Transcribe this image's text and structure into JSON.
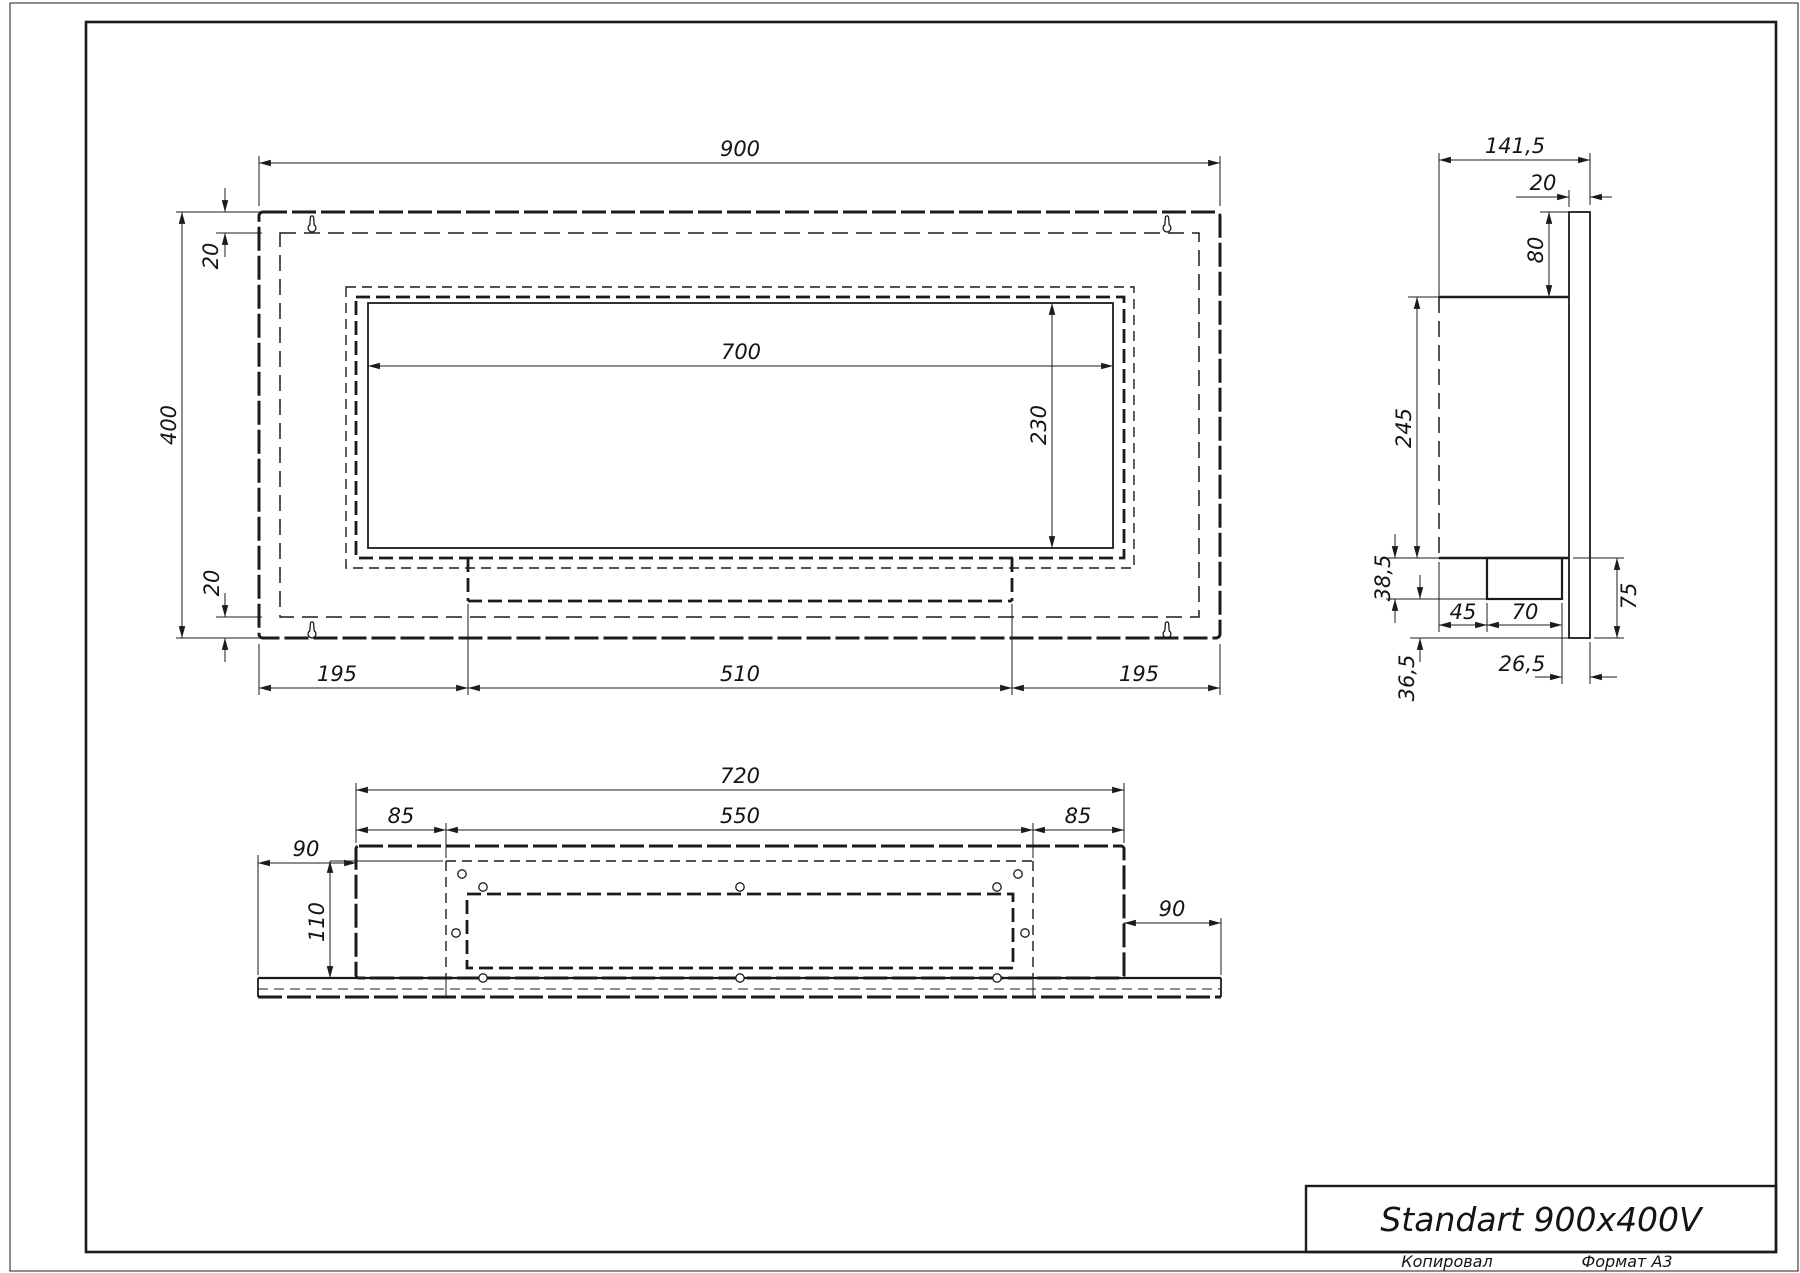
{
  "title_block": {
    "title": "Standart 900x400V"
  },
  "footer": {
    "copied_label": "Копировал",
    "format_label": "Формат А3"
  },
  "front_view": {
    "dims": {
      "overall_width": "900",
      "overall_height": "400",
      "top_offset": "20",
      "bottom_offset": "20",
      "opening_width": "700",
      "opening_height": "230",
      "bottom_left": "195",
      "bottom_center": "510",
      "bottom_right": "195"
    }
  },
  "side_view": {
    "dims": {
      "overall_depth": "141,5",
      "flange_thickness": "20",
      "flange_top_to_body": "80",
      "body_height": "245",
      "tray_height": "38,5",
      "tray_bottom_to_flange": "36,5",
      "back_to_tray": "45",
      "tray_depth": "70",
      "tray_to_front": "26,5",
      "flange_below_body": "75"
    }
  },
  "bottom_view": {
    "dims": {
      "body_width": "720",
      "opening_width": "550",
      "margin_left": "85",
      "margin_right": "85",
      "overhang_left": "90",
      "overhang_right": "90",
      "opening_depth": "110"
    }
  }
}
